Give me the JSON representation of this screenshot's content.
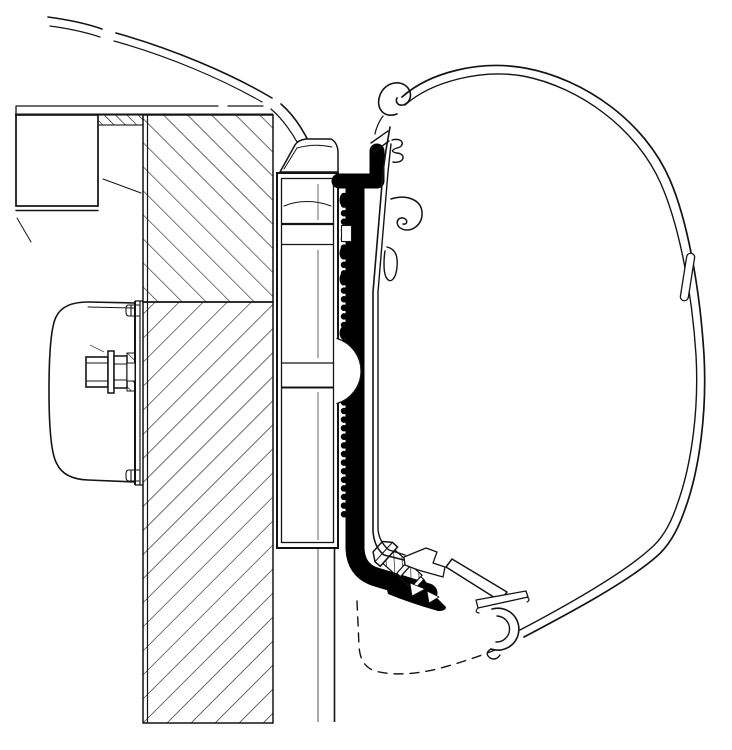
{
  "meta": {
    "title": "Awning adapter mounting cross-section technical drawing",
    "text_content": "none"
  },
  "colors": {
    "background": "#ffffff",
    "line": "#141414",
    "black": "#000000",
    "thin": "#555555"
  },
  "parts": {
    "roof": "vehicle-roof-contour",
    "ceiling": "interior-ceiling-line",
    "leaders": "reference-leader-lines",
    "roof_block": "roof-frame-hatched-section",
    "infill": "wall-top-infill-strip",
    "wall": "vehicle-wall-hatched-section",
    "panel_lines": "outer-wall-panel-lines",
    "bracket": "adapter-mounting-bracket",
    "cap": "wall-top-cap-profile",
    "rail": "serrated-adapter-rail",
    "tube": "torsion-tube-contour",
    "screw": "diagonal-fixing-screw",
    "profile": "cassette-mounting-profile-hooks",
    "case": "awning-cassette-shell",
    "seam": "cassette-shell-seam-clip",
    "lower_rail": "cassette-bottom-rail",
    "hidden": "hidden-contour-dashed",
    "clamp": "interior-clamp-plate-cover",
    "bolt": "clamp-hex-bolt-assembly"
  }
}
